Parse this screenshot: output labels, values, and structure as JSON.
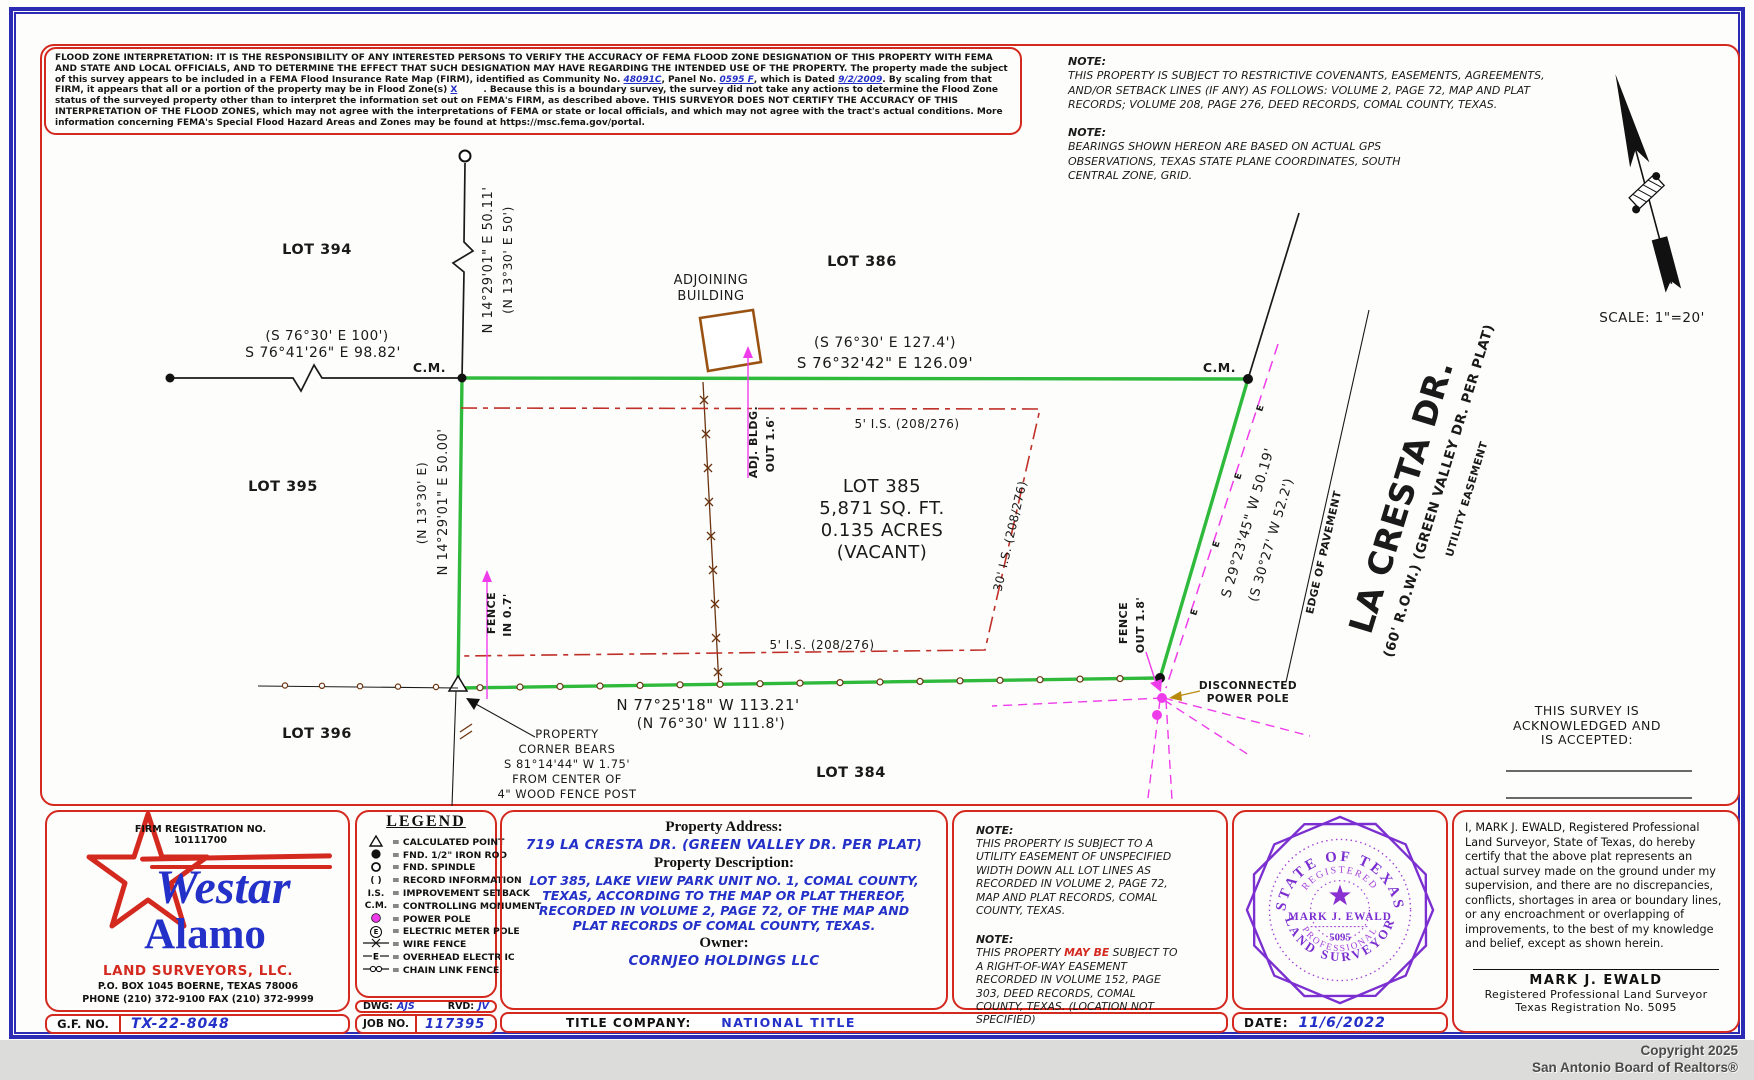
{
  "flood": {
    "seg1": "FLOOD ZONE INTERPRETATION: IT IS THE RESPONSIBILITY OF ANY INTERESTED PERSONS TO VERIFY THE ACCURACY OF FEMA FLOOD ZONE DESIGNATION OF THIS PROPERTY WITH FEMA AND STATE AND LOCAL OFFICIALS, AND TO DETERMINE THE EFFECT THAT SUCH DESIGNATION MAY HAVE REGARDING THE INTENDED USE OF THE PROPERTY. The property made the subject of this survey appears to be included in a FEMA Flood Insurance Rate Map (FIRM), identified as Community No. ",
    "seg2": "48091C",
    "seg3": ", Panel No. ",
    "seg4": "0595 F",
    "seg5": ", which is Dated ",
    "seg6": "9/2/2009",
    "seg7": ". By scaling from that FIRM, it appears that all or a portion of the property may be in Flood Zone(s) ",
    "seg8": "X",
    "seg9": ". Because this is a boundary survey, the survey did not take any actions to determine the Flood Zone status of the surveyed property other than to interpret the information set out on FEMA's FIRM, as described above. THIS SURVEYOR DOES NOT CERTIFY THE ACCURACY OF THIS INTERPRETATION OF THE FLOOD ZONES, which may not agree with the interpretations of FEMA or state or local officials, and which may not agree with the tract's actual conditions. More information concerning FEMA's Special Flood Hazard Areas and Zones may be found at https://msc.fema.gov/portal."
  },
  "notes_top": {
    "label1": "NOTE:",
    "body1": "THIS PROPERTY IS SUBJECT TO RESTRICTIVE COVENANTS, EASEMENTS, AGREEMENTS, AND/OR SETBACK LINES (IF ANY) AS FOLLOWS: VOLUME 2, PAGE 72, MAP AND PLAT RECORDS; VOLUME 208, PAGE 276, DEED RECORDS, COMAL COUNTY, TEXAS.",
    "label2": "NOTE:",
    "body2": "BEARINGS SHOWN HEREON ARE BASED ON ACTUAL GPS OBSERVATIONS, TEXAS STATE PLANE COORDINATES, SOUTH CENTRAL ZONE, GRID."
  },
  "plat": {
    "cm": "C.M.",
    "west_rec": "(S 76°30' E   100')",
    "west_meas": "S 76°41'26\" E   98.82'",
    "stub_meas": "N 14°29'01\" E   50.11'",
    "stub_rec": "(N 13°30' E   50')",
    "top_rec": "(S 76°30' E   127.4')",
    "top_meas": "S 76°32'42\" E   126.09'",
    "left_meas": "N 14°29'01\" E   50.00'",
    "left_rec": "(N 13°30' E)",
    "se_meas": "S 29°23'45\" W   50.19'",
    "se_rec": "(S 30°27' W   52.2')",
    "bottom_meas": "N 77°25'18\" W   113.21'",
    "bottom_rec": "(N 76°30' W   111.8')",
    "lot394": "LOT 394",
    "lot386": "LOT 386",
    "lot395": "LOT 395",
    "lot396": "LOT 396",
    "lot384": "LOT 384",
    "lot385_name": "LOT 385",
    "lot385_area": "5,871 SQ. FT.",
    "lot385_acres": "0.135 ACRES",
    "lot385_status": "(VACANT)",
    "setback_top": "5' I.S.  (208/276)",
    "setback_bottom": "5' I.S.  (208/276)",
    "setback_right": "30' I.S.  (208/276)",
    "adjoining_1": "ADJOINING",
    "adjoining_2": "BUILDING",
    "adj_bldg_1": "ADJ. BLDG.",
    "adj_bldg_2": "OUT 1.6'",
    "fence_in_1": "FENCE",
    "fence_in_2": "IN 0.7'",
    "fence_out_1": "FENCE",
    "fence_out_2": "OUT 1.8'",
    "disconnected_1": "DISCONNECTED",
    "disconnected_2": "POWER POLE",
    "corner_1": "PROPERTY",
    "corner_2": "CORNER BEARS",
    "corner_3": "S 81°14'44\" W   1.75'",
    "corner_4": "FROM CENTER OF",
    "corner_5": "4\" WOOD FENCE POST",
    "street_name": "LA CRESTA DR.",
    "street_sub": "(60' R.O.W.) (GREEN VALLEY DR. PER PLAT)",
    "utility": "UTILITY EASEMENT",
    "edge": "EDGE OF PAVEMENT",
    "ack_1": "THIS SURVEY IS",
    "ack_2": "ACKNOWLEDGED AND",
    "ack_3": "IS ACCEPTED:",
    "scale": "SCALE:  1\"=20'",
    "e_sym": "E"
  },
  "legend": {
    "title": "LEGEND",
    "items": [
      {
        "sym": "",
        "label": "= CALCULATED POINT"
      },
      {
        "sym": "",
        "label": "= FND. 1/2\" IRON ROD"
      },
      {
        "sym": "",
        "label": "= FND. SPINDLE"
      },
      {
        "sym": "(  )",
        "label": "= RECORD INFORMATION"
      },
      {
        "sym": "I.S.",
        "label": "= IMPROVEMENT SETBACK"
      },
      {
        "sym": "C.M.",
        "label": "= CONTROLLING MONUMENT"
      },
      {
        "sym": "",
        "label": "= POWER POLE"
      },
      {
        "sym": "E",
        "label": "= ELECTRIC METER POLE"
      },
      {
        "sym": "",
        "label": "= WIRE FENCE"
      },
      {
        "sym": "E",
        "label": "= OVERHEAD ELECTR IC"
      },
      {
        "sym": "",
        "label": "= CHAIN LINK FENCE"
      }
    ]
  },
  "firm": {
    "reg_label": "FIRM REGISTRATION NO.",
    "reg_no": "10111700",
    "name1": "Westar",
    "name2": "Alamo",
    "tagline": "LAND SURVEYORS, LLC.",
    "address": "P.O. BOX 1045 BOERNE, TEXAS 78006",
    "phone": "PHONE (210) 372-9100   FAX (210) 372-9999",
    "gf_label": "G.F. NO.",
    "gf_value": "TX-22-8048"
  },
  "drafting": {
    "dwg_label": "DWG:",
    "dwg": "AJS",
    "rvd_label": "RVD:",
    "rvd": "JV",
    "job_label": "JOB NO.",
    "job": "117395"
  },
  "property": {
    "address_label": "Property Address:",
    "address": "719 LA CRESTA DR.  (GREEN VALLEY DR. PER PLAT)",
    "description_label": "Property Description:",
    "description": "LOT 385, LAKE VIEW PARK UNIT NO. 1, COMAL COUNTY, TEXAS, ACCORDING TO THE MAP OR PLAT THEREOF, RECORDED IN VOLUME 2, PAGE 72, OF THE MAP AND PLAT RECORDS OF COMAL COUNTY, TEXAS.",
    "owner_label": "Owner:",
    "owner": "CORNJEO HOLDINGS LLC",
    "title_label": "TITLE COMPANY:",
    "title_company": "NATIONAL TITLE"
  },
  "notes_bottom": {
    "label1": "NOTE:",
    "body1": "THIS PROPERTY IS SUBJECT TO A UTILITY EASEMENT OF UNSPECIFIED WIDTH DOWN ALL LOT LINES AS RECORDED IN VOLUME 2, PAGE 72, MAP AND PLAT RECORDS, COMAL COUNTY, TEXAS.",
    "label2": "NOTE:",
    "body2a": "THIS PROPERTY ",
    "body2b": "MAY BE",
    "body2c": " SUBJECT TO A RIGHT-OF-WAY EASEMENT RECORDED IN VOLUME 152, PAGE 303, DEED RECORDS, COMAL COUNTY, TEXAS. (LOCATION NOT SPECIFIED)"
  },
  "seal": {
    "top": "STATE  OF  TEXAS",
    "registered": "REGISTERED",
    "name": "MARK J. EWALD",
    "number": "5095",
    "prof": "PROFESSIONAL",
    "surveyor": "LAND  SURVEYOR"
  },
  "certification": {
    "body": "I, MARK J. EWALD, Registered Professional Land Surveyor, State of Texas, do hereby certify that the above plat represents an actual survey made on the ground under my supervision, and there are no discrepancies, conflicts, shortages in area or boundary lines, or any encroachment or overlapping of improvements, to the best of my knowledge and belief, except as shown herein.",
    "sig_name": "MARK J. EWALD",
    "sig_title": "Registered Professional Land Surveyor",
    "sig_reg": "Texas Registration No. 5095",
    "date_label": "DATE:",
    "date": "11/6/2022"
  },
  "footer": {
    "line1": "Copyright 2025",
    "line2": "San Antonio Board of Realtors®"
  }
}
